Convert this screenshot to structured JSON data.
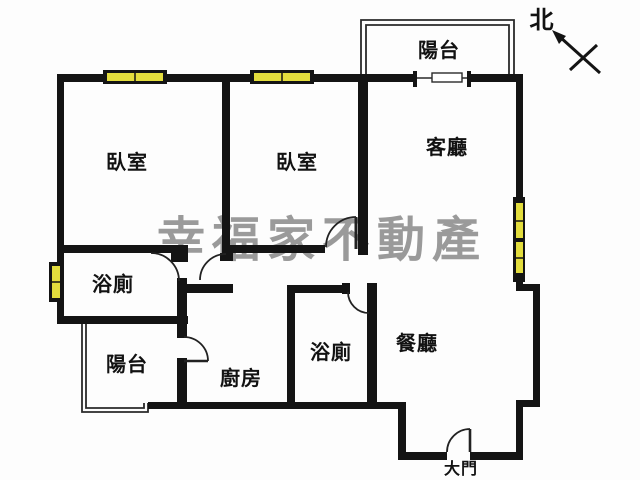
{
  "floorplan": {
    "title": "apartment-floor-plan",
    "watermark": "幸福家不動產",
    "compass": {
      "label": "北"
    },
    "rooms": {
      "bedroom1": {
        "label": "臥室"
      },
      "bedroom2": {
        "label": "臥室"
      },
      "living_room": {
        "label": "客廳"
      },
      "balcony_top": {
        "label": "陽台"
      },
      "bathroom1": {
        "label": "浴廁"
      },
      "balcony_bottom": {
        "label": "陽台"
      },
      "kitchen": {
        "label": "廚房"
      },
      "bathroom2": {
        "label": "浴廁"
      },
      "dining_room": {
        "label": "餐廳"
      }
    },
    "main_door": {
      "label": "大門"
    },
    "colors": {
      "wall": "#141414",
      "window_fill": "#e3dd3d",
      "watermark": "#9a9a9a",
      "thin_line": "#2a2a2a"
    }
  }
}
